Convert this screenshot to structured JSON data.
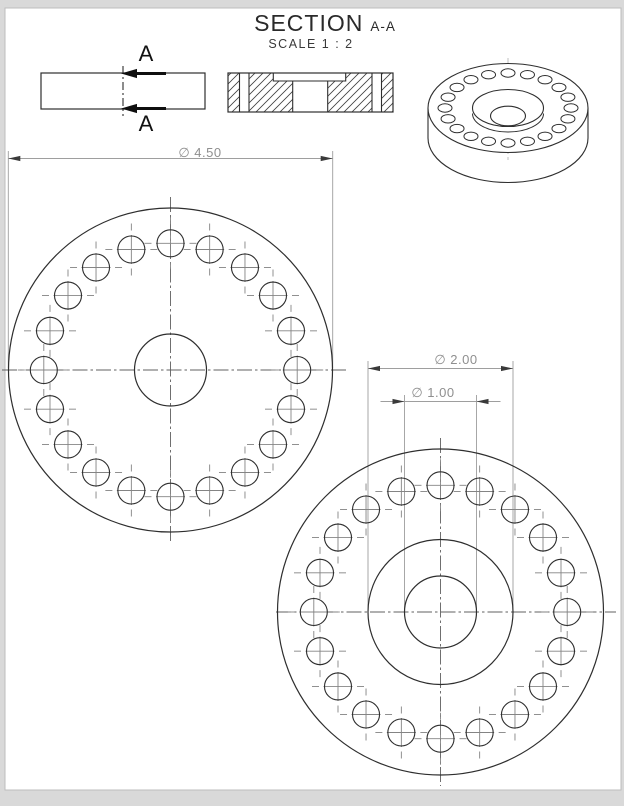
{
  "title": {
    "section_label": "SECTION",
    "section_name": "A-A",
    "scale_label": "SCALE 1 : 2"
  },
  "section_markers": {
    "top_label": "A",
    "bottom_label": "A"
  },
  "dimensions": [
    {
      "id": "outer-diameter",
      "label": "∅ 4.50",
      "line_y": 158.5,
      "x1": 8.3,
      "x2": 332.7,
      "ext_top": 151,
      "ext_bottom": 368,
      "text_cx": 200,
      "text_top": 145,
      "arrows": "inside"
    },
    {
      "id": "counterbore-diameter",
      "label": "∅ 2.00",
      "line_y": 368.5,
      "x1": 368,
      "x2": 513,
      "ext_top": 361,
      "ext_bottom": 610,
      "text_cx": 456,
      "text_top": 352,
      "arrows": "inside"
    },
    {
      "id": "center-hole-diameter",
      "label": "∅ 1.00",
      "line_y": 401.5,
      "x1": 404.5,
      "x2": 476.5,
      "ext_top": 395,
      "ext_bottom": 610,
      "text_cx": 433,
      "text_top": 385,
      "arrows": "outside"
    }
  ],
  "part": {
    "outer_diameter_in": 4.5,
    "counterbore_diameter_in": 2.0,
    "center_hole_diameter_in": 1.0,
    "bolt_hole_count": 20
  },
  "views": {
    "side": {
      "x": 41,
      "y": 73,
      "w": 164,
      "h": 36,
      "cut_x": 123,
      "cut_y1": 66,
      "cut_y2": 116
    },
    "section": {
      "x": 228,
      "y": 73,
      "w": 165,
      "h": 39,
      "recess": {
        "x1": 273.3,
        "x2": 345.7,
        "depth": 8
      },
      "hole": {
        "x1": 292.7,
        "x2": 327.7
      },
      "bolt_holes": [
        [
          239.5,
          249
        ],
        [
          372,
          381.5
        ]
      ]
    },
    "front": {
      "cx": 170.5,
      "cy": 370,
      "r_outer": 162,
      "r_center_hole": 36,
      "r_bolt_circle": 126.7,
      "hole_r": 13.5,
      "hole_count": 20,
      "cl_h": [
        2,
        348
      ],
      "cl_v": [
        197,
        544
      ]
    },
    "back": {
      "cx": 440.5,
      "cy": 612,
      "r_outer": 163,
      "r_counterbore": 72.5,
      "r_center_hole": 36,
      "r_bolt_circle": 126.7,
      "hole_r": 13.5,
      "hole_count": 20,
      "cl_h": [
        276,
        616
      ],
      "cl_v": [
        438,
        786
      ]
    },
    "iso": {
      "cx": 508,
      "cy": 108,
      "rx": 80,
      "ry": 44.5,
      "thickness": 30,
      "ring_rx": 63,
      "ring_ry": 35,
      "hole_rx": 7,
      "hole_ry": 4.2,
      "hole_count": 20,
      "cbore_rx": 35.5,
      "cbore_ry": 18.5,
      "floor_dy": 5.5,
      "hole_ellipse_rx": 17.5,
      "hole_ellipse_ry": 9.8,
      "hole_ellipse_dy": 8,
      "cl_v": [
        58,
        160
      ]
    }
  },
  "sheet": {
    "x": 5,
    "y": 8,
    "w": 616,
    "h": 782
  },
  "colors": {
    "background": "#d9d9d9",
    "sheet": "#ffffff",
    "sheet_edge": "#bdbdbd",
    "geometry": "#2e2e2e",
    "centerline": "#606060",
    "hole_cross": "#848484",
    "dimension": "#9e9e9e",
    "dim_arrow": "#3a3a3a",
    "section_arrow": "#0f0f0f",
    "hatch": "#3f3f3f"
  }
}
